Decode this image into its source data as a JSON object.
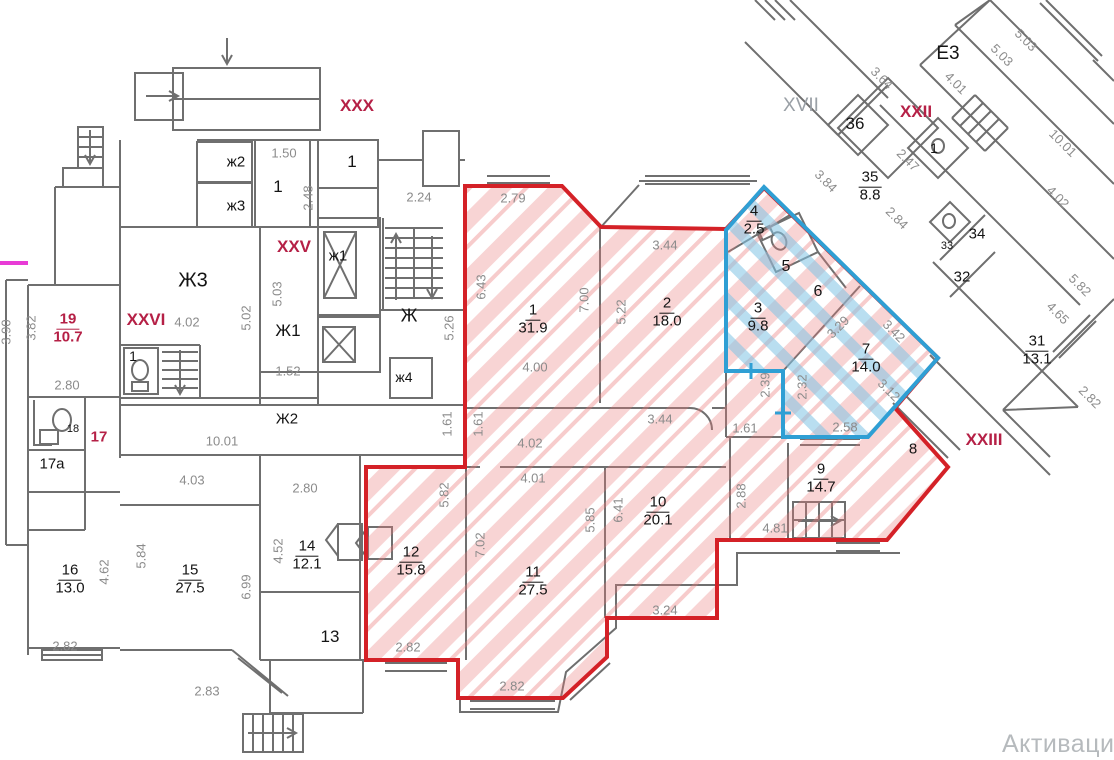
{
  "watermark": "Активаци",
  "colors": {
    "red_zone_border": "#d42127",
    "red_zone_hatch": "#eb7a7a",
    "blue_zone_border": "#2f9fd4",
    "blue_zone_hatch": "#7fc3e4",
    "wall_gray": "#6f6f6f",
    "dim_text": "#8b8b8b",
    "roman_crimson": "#b52046",
    "magenta_mark": "#e83bd6"
  },
  "rooms": [
    {
      "num": "19",
      "area": "10.7",
      "x": 68,
      "y": 329,
      "cls": "crim-f"
    },
    {
      "num": "16",
      "area": "13.0",
      "x": 70,
      "y": 580
    },
    {
      "num": "15",
      "area": "27.5",
      "x": 190,
      "y": 580
    },
    {
      "num": "14",
      "area": "12.1",
      "x": 307,
      "y": 556
    },
    {
      "num": "1",
      "area": "31.9",
      "x": 533,
      "y": 320
    },
    {
      "num": "2",
      "area": "18.0",
      "x": 667,
      "y": 313
    },
    {
      "num": "12",
      "area": "15.8",
      "x": 411,
      "y": 562
    },
    {
      "num": "11",
      "area": "27.5",
      "x": 533,
      "y": 582
    },
    {
      "num": "10",
      "area": "20.1",
      "x": 658,
      "y": 512
    },
    {
      "num": "9",
      "area": "14.7",
      "x": 821,
      "y": 479
    },
    {
      "num": "3",
      "area": "9.8",
      "x": 758,
      "y": 318
    },
    {
      "num": "4",
      "area": "2.5",
      "x": 754,
      "y": 221
    },
    {
      "num": "7",
      "area": "14.0",
      "x": 866,
      "y": 359
    },
    {
      "num": "35",
      "area": "8.8",
      "x": 870,
      "y": 187
    },
    {
      "num": "31",
      "area": "13.1",
      "x": 1037,
      "y": 351
    }
  ],
  "labels": [
    {
      "t": "1.50",
      "x": 284,
      "y": 153,
      "cls": "dim"
    },
    {
      "t": "2.24",
      "x": 419,
      "y": 197,
      "cls": "dim"
    },
    {
      "t": "2.79",
      "x": 513,
      "y": 198,
      "cls": "dim"
    },
    {
      "t": "3.44",
      "x": 665,
      "y": 245,
      "cls": "dim"
    },
    {
      "t": "4.00",
      "x": 535,
      "y": 367,
      "cls": "dim"
    },
    {
      "t": "4.02",
      "x": 530,
      "y": 443,
      "cls": "dim"
    },
    {
      "t": "3.44",
      "x": 660,
      "y": 419,
      "cls": "dim"
    },
    {
      "t": "1.61",
      "x": 745,
      "y": 428,
      "cls": "dim"
    },
    {
      "t": "4.01",
      "x": 533,
      "y": 478,
      "cls": "dim"
    },
    {
      "t": "2.58",
      "x": 845,
      "y": 427,
      "cls": "dim"
    },
    {
      "t": "4.02",
      "x": 187,
      "y": 322,
      "cls": "dim"
    },
    {
      "t": "1.52",
      "x": 288,
      "y": 371,
      "cls": "dim"
    },
    {
      "t": "2.80",
      "x": 67,
      "y": 385,
      "cls": "dim"
    },
    {
      "t": "10.01",
      "x": 222,
      "y": 441,
      "cls": "dim"
    },
    {
      "t": "4.03",
      "x": 192,
      "y": 480,
      "cls": "dim"
    },
    {
      "t": "2.80",
      "x": 305,
      "y": 488,
      "cls": "dim"
    },
    {
      "t": "2.82",
      "x": 65,
      "y": 646,
      "cls": "dim"
    },
    {
      "t": "2.83",
      "x": 207,
      "y": 691,
      "cls": "dim"
    },
    {
      "t": "2.82",
      "x": 408,
      "y": 647,
      "cls": "dim"
    },
    {
      "t": "2.82",
      "x": 512,
      "y": 686,
      "cls": "dim"
    },
    {
      "t": "3.24",
      "x": 665,
      "y": 610,
      "cls": "dim"
    },
    {
      "t": "4.81",
      "x": 775,
      "y": 528,
      "cls": "dim"
    },
    {
      "t": "3.90",
      "x": 6,
      "y": 332,
      "r": -90,
      "cls": "dim"
    },
    {
      "t": "3.82",
      "x": 31,
      "y": 328,
      "r": -90,
      "cls": "dim"
    },
    {
      "t": "5.02",
      "x": 246,
      "y": 318,
      "r": -90,
      "cls": "dim"
    },
    {
      "t": "5.03",
      "x": 277,
      "y": 294,
      "r": -90,
      "cls": "dim"
    },
    {
      "t": "2.48",
      "x": 308,
      "y": 198,
      "r": -90,
      "cls": "dim"
    },
    {
      "t": "5.26",
      "x": 449,
      "y": 328,
      "r": -90,
      "cls": "dim"
    },
    {
      "t": "6.43",
      "x": 481,
      "y": 287,
      "r": -90,
      "cls": "dim"
    },
    {
      "t": "7.00",
      "x": 584,
      "y": 300,
      "r": -90,
      "cls": "dim"
    },
    {
      "t": "5.22",
      "x": 621,
      "y": 312,
      "r": -90,
      "cls": "dim"
    },
    {
      "t": "1.61",
      "x": 447,
      "y": 424,
      "r": -90,
      "cls": "dim"
    },
    {
      "t": "1.61",
      "x": 478,
      "y": 424,
      "r": -90,
      "cls": "dim"
    },
    {
      "t": "4.62",
      "x": 104,
      "y": 572,
      "r": -90,
      "cls": "dim"
    },
    {
      "t": "5.84",
      "x": 141,
      "y": 556,
      "r": -90,
      "cls": "dim"
    },
    {
      "t": "6.99",
      "x": 246,
      "y": 587,
      "r": -90,
      "cls": "dim"
    },
    {
      "t": "4.52",
      "x": 278,
      "y": 551,
      "r": -90,
      "cls": "dim"
    },
    {
      "t": "5.82",
      "x": 444,
      "y": 495,
      "r": -90,
      "cls": "dim"
    },
    {
      "t": "7.02",
      "x": 480,
      "y": 545,
      "r": -90,
      "cls": "dim"
    },
    {
      "t": "5.85",
      "x": 590,
      "y": 520,
      "r": -90,
      "cls": "dim"
    },
    {
      "t": "6.41",
      "x": 618,
      "y": 510,
      "r": -90,
      "cls": "dim"
    },
    {
      "t": "2.88",
      "x": 741,
      "y": 496,
      "r": -90,
      "cls": "dim"
    },
    {
      "t": "2.39",
      "x": 765,
      "y": 385,
      "r": -90,
      "cls": "dim"
    },
    {
      "t": "2.32",
      "x": 802,
      "y": 387,
      "r": -90,
      "cls": "dim"
    },
    {
      "t": "3.64",
      "x": 882,
      "y": 78,
      "r": 45,
      "cls": "dim"
    },
    {
      "t": "4.01",
      "x": 956,
      "y": 83,
      "r": 45,
      "cls": "dim"
    },
    {
      "t": "5.03",
      "x": 1002,
      "y": 55,
      "r": 45,
      "cls": "dim"
    },
    {
      "t": "5.03",
      "x": 1026,
      "y": 40,
      "r": 45,
      "cls": "dim"
    },
    {
      "t": "2.47",
      "x": 908,
      "y": 160,
      "r": 45,
      "cls": "dim"
    },
    {
      "t": "3.84",
      "x": 826,
      "y": 181,
      "r": 45,
      "cls": "dim"
    },
    {
      "t": "2.84",
      "x": 897,
      "y": 218,
      "r": 45,
      "cls": "dim"
    },
    {
      "t": "10.01",
      "x": 1063,
      "y": 143,
      "r": 45,
      "cls": "dim"
    },
    {
      "t": "4.02",
      "x": 1058,
      "y": 197,
      "r": 45,
      "cls": "dim"
    },
    {
      "t": "5.82",
      "x": 1080,
      "y": 285,
      "r": 45,
      "cls": "dim"
    },
    {
      "t": "4.65",
      "x": 1058,
      "y": 313,
      "r": 45,
      "cls": "dim"
    },
    {
      "t": "2.82",
      "x": 1090,
      "y": 397,
      "r": 45,
      "cls": "dim"
    },
    {
      "t": "3.42",
      "x": 894,
      "y": 331,
      "r": 45,
      "cls": "dim"
    },
    {
      "t": "3.12",
      "x": 889,
      "y": 390,
      "r": 45,
      "cls": "dim"
    },
    {
      "t": "3.29",
      "x": 838,
      "y": 327,
      "r": -45,
      "cls": "dim"
    },
    {
      "t": "ж2",
      "x": 236,
      "y": 162,
      "cls": "name"
    },
    {
      "t": "ж3",
      "x": 236,
      "y": 206,
      "cls": "name"
    },
    {
      "t": "1",
      "x": 278,
      "y": 187,
      "cls": "name",
      "fz": 17
    },
    {
      "t": "1",
      "x": 352,
      "y": 162,
      "cls": "name",
      "fz": 17
    },
    {
      "t": "Ж3",
      "x": 193,
      "y": 281,
      "cls": "name",
      "fz": 20
    },
    {
      "t": "ж1",
      "x": 338,
      "y": 256,
      "cls": "name"
    },
    {
      "t": "Ж1",
      "x": 288,
      "y": 331,
      "cls": "name",
      "fz": 17
    },
    {
      "t": "Ж",
      "x": 409,
      "y": 316,
      "cls": "name",
      "fz": 18
    },
    {
      "t": "ж4",
      "x": 404,
      "y": 377,
      "cls": "name",
      "fz": 14
    },
    {
      "t": "1",
      "x": 133,
      "y": 356,
      "cls": "name",
      "fz": 14
    },
    {
      "t": "Ж2",
      "x": 287,
      "y": 419,
      "cls": "name"
    },
    {
      "t": "17а",
      "x": 52,
      "y": 464,
      "cls": "name"
    },
    {
      "t": "18",
      "x": 73,
      "y": 429,
      "cls": "name",
      "fz": 11
    },
    {
      "t": "13",
      "x": 330,
      "y": 637,
      "cls": "name",
      "fz": 17
    },
    {
      "t": "E3",
      "x": 948,
      "y": 54,
      "cls": "name",
      "fz": 19
    },
    {
      "t": "36",
      "x": 855,
      "y": 124,
      "cls": "name",
      "fz": 17
    },
    {
      "t": "1",
      "x": 934,
      "y": 148,
      "cls": "name",
      "fz": 14
    },
    {
      "t": "33",
      "x": 947,
      "y": 246,
      "cls": "name",
      "fz": 11
    },
    {
      "t": "34",
      "x": 977,
      "y": 234,
      "cls": "name"
    },
    {
      "t": "32",
      "x": 962,
      "y": 277,
      "cls": "name"
    },
    {
      "t": "8",
      "x": 913,
      "y": 449,
      "cls": "name"
    },
    {
      "t": "5",
      "x": 786,
      "y": 267,
      "cls": "name",
      "fz": 16
    },
    {
      "t": "6",
      "x": 818,
      "y": 292,
      "cls": "name",
      "fz": 16
    },
    {
      "t": "XVII",
      "x": 801,
      "y": 106,
      "cls": "graybig"
    },
    {
      "t": "XXX",
      "x": 357,
      "y": 106,
      "cls": "crim"
    },
    {
      "t": "XXV",
      "x": 294,
      "y": 247,
      "cls": "crim"
    },
    {
      "t": "XXVI",
      "x": 146,
      "y": 320,
      "cls": "crim"
    },
    {
      "t": "XXII",
      "x": 916,
      "y": 112,
      "cls": "crim"
    },
    {
      "t": "XXIII",
      "x": 984,
      "y": 440,
      "cls": "crim"
    },
    {
      "t": "17",
      "x": 99,
      "y": 437,
      "cls": "crim",
      "fz": 15
    }
  ]
}
